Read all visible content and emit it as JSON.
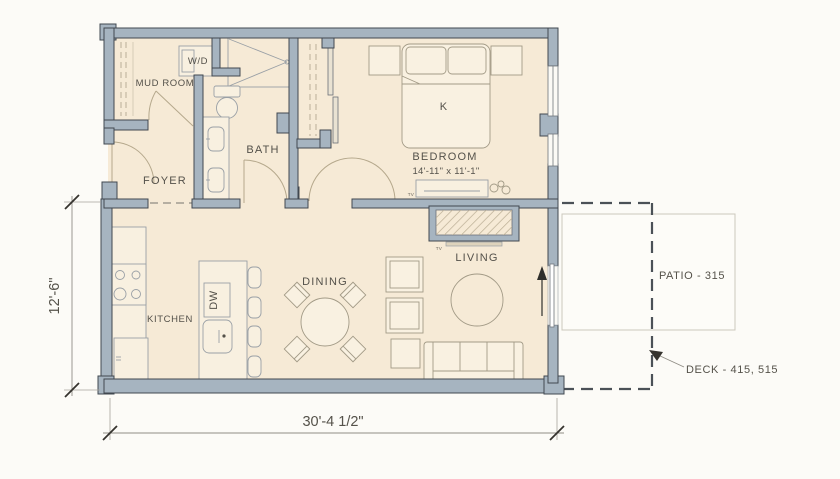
{
  "plan_title": "One-bedroom unit floor plan",
  "rooms": {
    "mud_room": {
      "label": "MUD ROOM"
    },
    "foyer": {
      "label": "FOYER"
    },
    "bath": {
      "label": "BATH"
    },
    "bedroom": {
      "label": "BEDROOM",
      "dims": "14'-11\" x 11'-1\"",
      "bed": "K"
    },
    "kitchen": {
      "label": "KITCHEN"
    },
    "dining": {
      "label": "DINING"
    },
    "living": {
      "label": "LIVING"
    }
  },
  "appliances": {
    "washer_dryer": "W/D",
    "dishwasher": "DW",
    "tv_bedroom": "TV",
    "tv_living": "TV"
  },
  "outdoor": {
    "patio_label": "PATIO - 315",
    "deck_label": "DECK - 415, 515"
  },
  "dimensions": {
    "overall_width": "30'-4 1/2\"",
    "overall_depth": "12'-6\""
  },
  "colors": {
    "wall": "#a6b4c0",
    "floor": "#f6ead6",
    "paper": "#fcfbf7",
    "fixture_line": "#9aa0a6",
    "furniture_line": "#a29a86",
    "text": "#54514a"
  }
}
